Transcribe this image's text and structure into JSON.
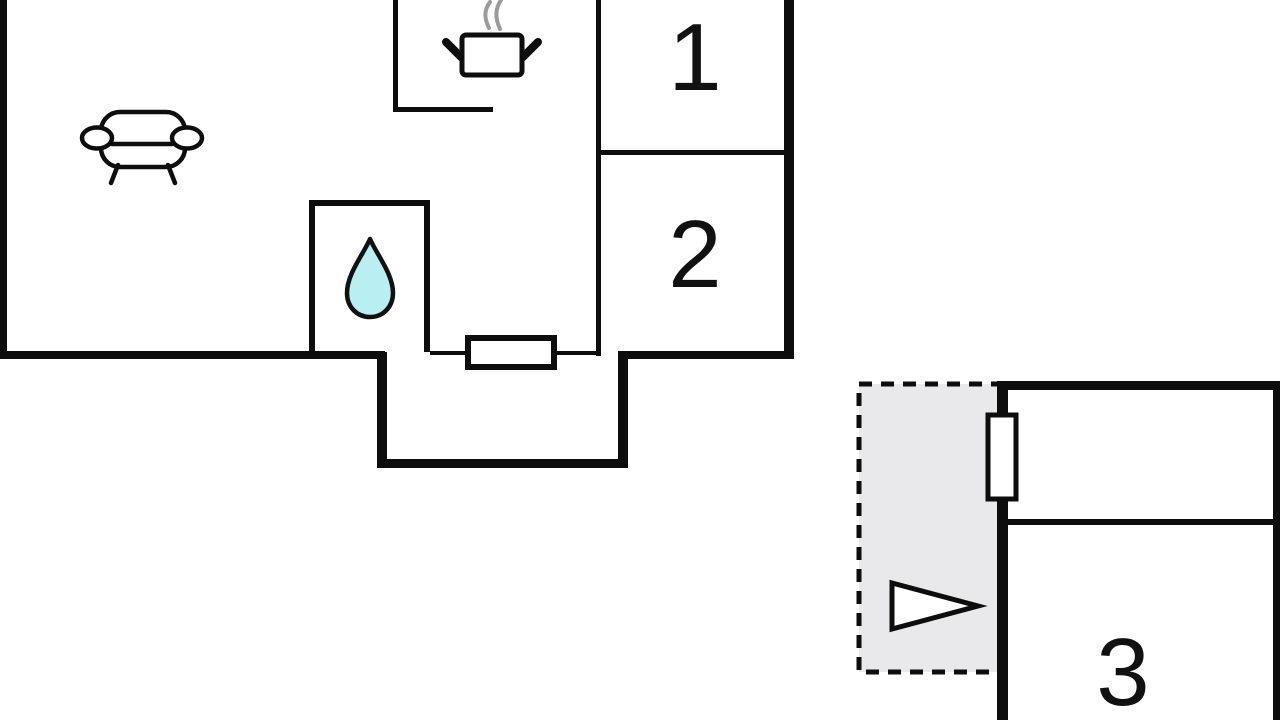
{
  "floorplan": {
    "type": "floor-plan",
    "rooms": [
      {
        "id": "room-1",
        "label": "1"
      },
      {
        "id": "room-2",
        "label": "2"
      },
      {
        "id": "room-3",
        "label": "3"
      }
    ],
    "icons": [
      "sofa-icon",
      "cooking-pot-icon",
      "steam-icon",
      "water-drop-icon",
      "entrance-door-icon",
      "window-icon",
      "entrance-arrow-icon"
    ],
    "colors": {
      "wall": "#0d0d0d",
      "drop_fill": "#b9eef2",
      "zone_fill": "#e9e9eb",
      "steam": "#9b9b9b",
      "background": "#ffffff"
    }
  }
}
